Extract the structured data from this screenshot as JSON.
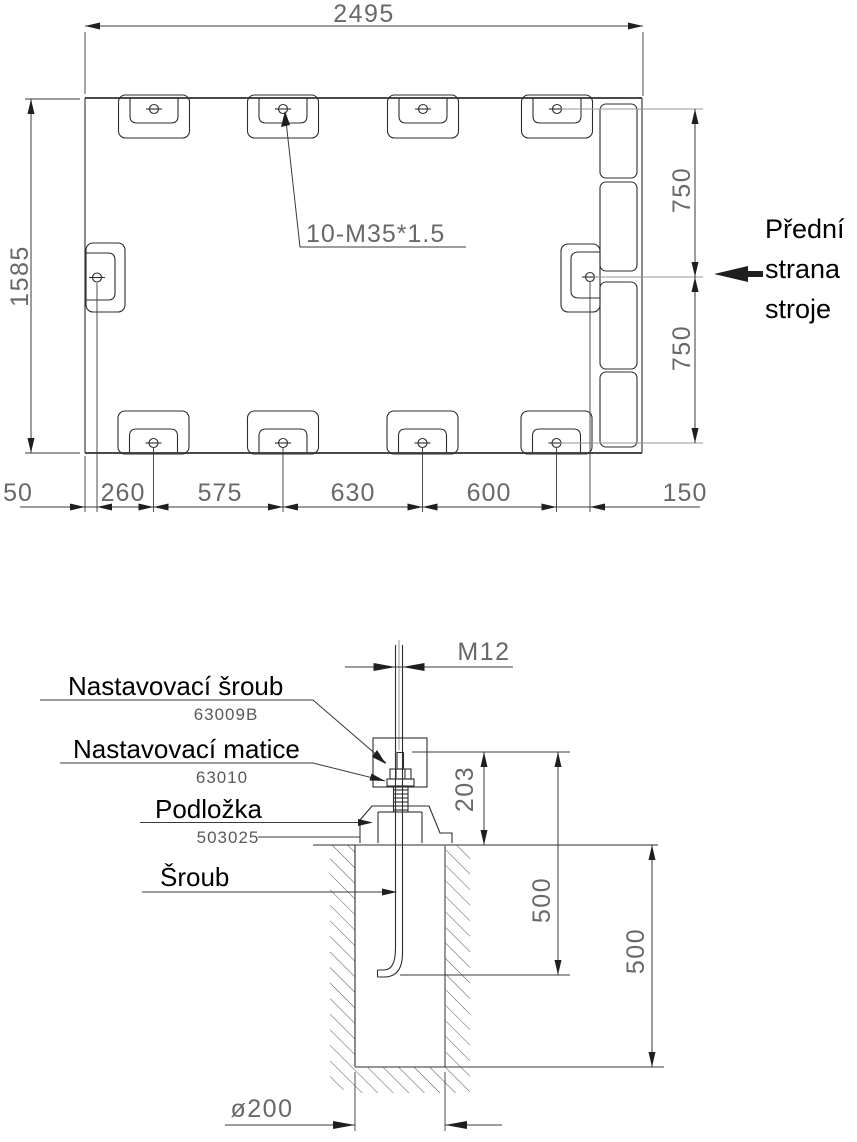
{
  "plan": {
    "dim_width": "2495",
    "dim_height": "1585",
    "dim_row_upper": "750",
    "dim_row_lower": "750",
    "chain": [
      "50",
      "260",
      "575",
      "630",
      "600",
      "150"
    ],
    "hole_note": "10-M35*1.5",
    "front_label": [
      "Přední",
      "strana",
      "stroje"
    ]
  },
  "detail": {
    "dim_thread": "M12",
    "dim_plate_height": "203",
    "dim_bolt_depth": "500",
    "dim_pit_depth": "500",
    "dim_pit_diameter": "ø200",
    "parts": [
      {
        "label": "Nastavovací šroub",
        "part_no": "63009B"
      },
      {
        "label": "Nastavovací matice",
        "part_no": "63010"
      },
      {
        "label": "Podložka",
        "part_no": "503025"
      },
      {
        "label": "Šroub",
        "part_no": ""
      }
    ]
  },
  "colors": {
    "line": "#2e2e2e",
    "aux_line": "#9a9a9a",
    "dim_text": "#686868",
    "label_text": "#000000",
    "background": "#ffffff"
  }
}
